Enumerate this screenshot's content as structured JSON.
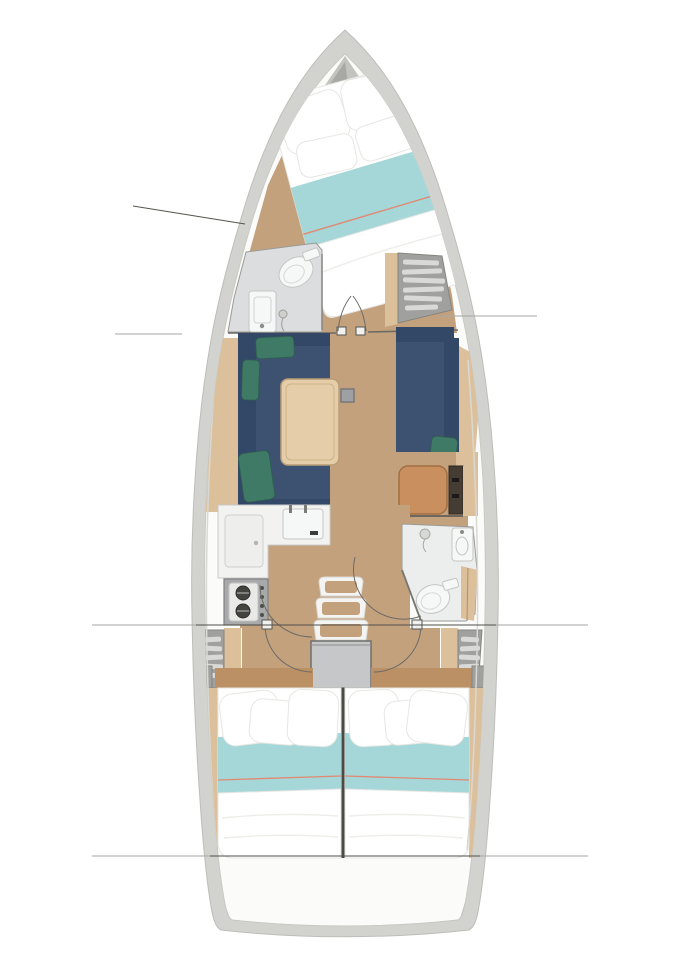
{
  "diagram": {
    "type": "yacht-interior-floor-plan",
    "orientation": "bow-up",
    "regions": [
      {
        "id": "anchor-locker",
        "label": "anchor locker"
      },
      {
        "id": "forward-cabin",
        "label": "forward cabin v-berth"
      },
      {
        "id": "forward-head",
        "label": "forward head bathroom"
      },
      {
        "id": "forward-locker",
        "label": "forward shelved locker"
      },
      {
        "id": "saloon",
        "label": "saloon with sofas and table"
      },
      {
        "id": "nav-seat",
        "label": "chart table seat"
      },
      {
        "id": "galley",
        "label": "galley with sink and stove"
      },
      {
        "id": "aft-head",
        "label": "aft head bathroom"
      },
      {
        "id": "companionway",
        "label": "companionway steps and engine box"
      },
      {
        "id": "aft-cabin-port",
        "label": "port aft cabin double berth"
      },
      {
        "id": "aft-cabin-starboard",
        "label": "starboard aft cabin double berth"
      },
      {
        "id": "transom",
        "label": "stern transom"
      }
    ],
    "section_lines": [
      "bow diagonal",
      "port mid",
      "starboard mid",
      "full beam at galley",
      "full beam at stern"
    ]
  },
  "colors": {
    "hull_gray": "#d2d2ce",
    "hull_edge": "#bdbdb9",
    "liner": "#fbfbfa",
    "anchor_dark": "#a8a8a4",
    "anchor_mid": "#c2c2be",
    "wood": "#c4a17d",
    "wood_dark": "#bb9064",
    "wood_light": "#dcc09c",
    "table_wood": "#e4cda8",
    "navy": "#3c5270",
    "navy_dark": "#334766",
    "green": "#3e7a66",
    "green_dark": "#2f5f4f",
    "aqua": "#a5d6d8",
    "coral": "#e08a72",
    "room_gray": "#dcdddf",
    "fixture": "#f6f7f7",
    "stove": "#a8a9aa",
    "burner": "#44443f",
    "engine": "#c6c7c8",
    "seat_orange": "#c98f5e",
    "seat_border": "#a06f42",
    "cabinet": "#453d33",
    "shelf_gray": "#a0a09e",
    "slat": "#d9d9d7",
    "line_dark": "#55554f",
    "line_light": "#a6a6a2",
    "white_fabric": "#ffffff",
    "fabric_edge": "#e6e6e3"
  }
}
